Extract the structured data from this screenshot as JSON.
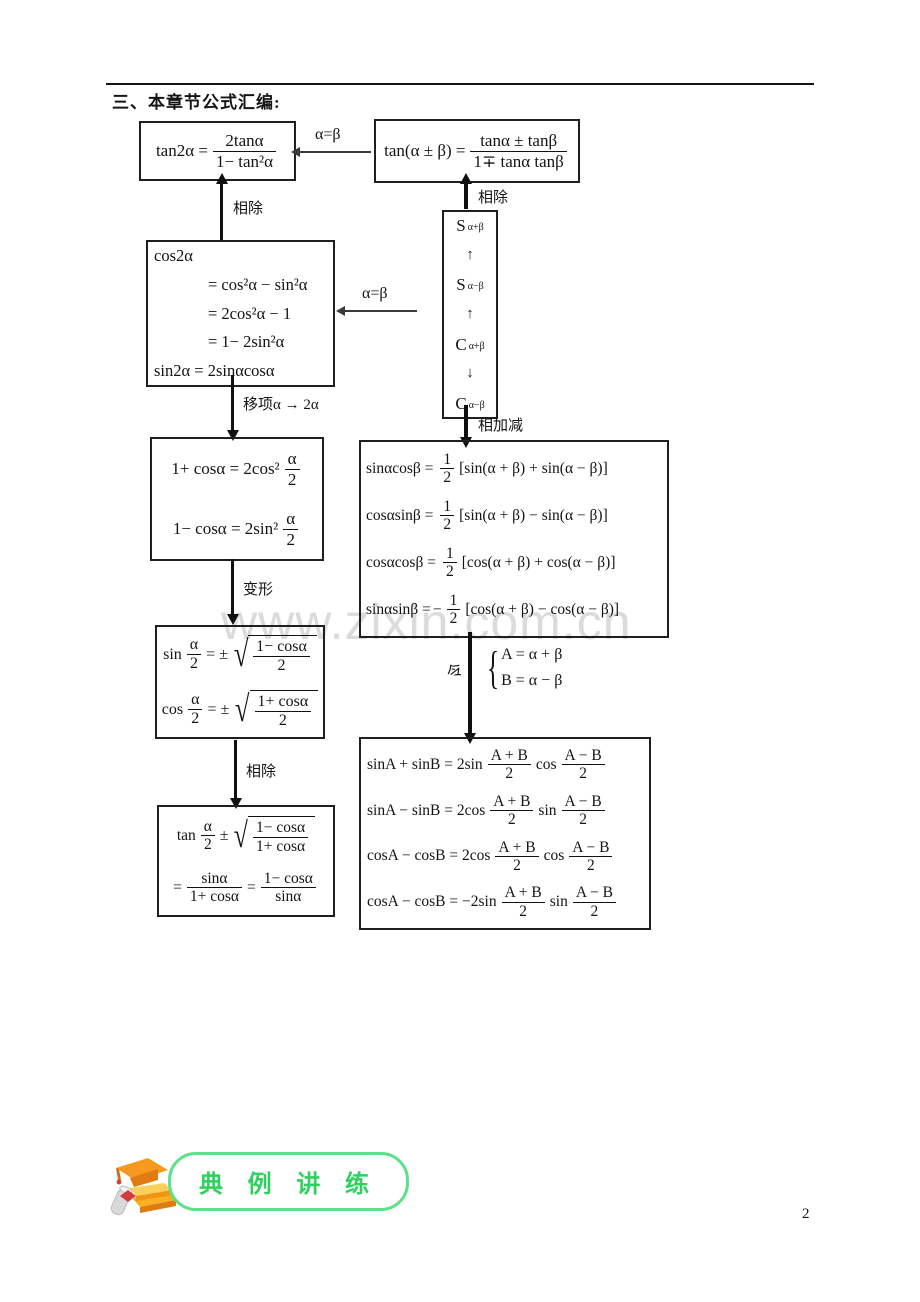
{
  "header": {
    "title": "三、本章节公式汇编:"
  },
  "watermark": "www.zixin.com.cn",
  "page_number": "2",
  "connectors": {
    "divide_left": "相除",
    "divide_right": "相除",
    "alpha_beta_top": "α=β",
    "alpha_beta_mid": "α=β",
    "shift": "移项α → 2α",
    "add_subtract": "相加减",
    "transform": "变形",
    "let": "令",
    "let_brace": "{",
    "let_line1": "A = α + β",
    "let_line2": "B = α − β",
    "divide_bottom": "相除"
  },
  "boxes": {
    "tan_double": {
      "lhs": "tan2α =",
      "num": "2tanα",
      "den": "1− tan²α"
    },
    "tan_sum": {
      "lhs": "tan(α ± β) =",
      "num": "tanα ± tanβ",
      "den": "1∓ tanα tanβ"
    },
    "cos_double": {
      "lines": [
        "cos2α",
        "= cos²α − sin²α",
        "= 2cos²α − 1",
        "= 1− 2sin²α",
        "sin2α = 2sinαcosα"
      ]
    },
    "sc_chain": {
      "items": [
        {
          "main": "S",
          "sub": "α+β"
        },
        {
          "arrow": "↑"
        },
        {
          "main": "S",
          "sub": "α−β"
        },
        {
          "arrow": "↑"
        },
        {
          "main": "C",
          "sub": "α+β"
        },
        {
          "arrow": "↓"
        },
        {
          "main": "C",
          "sub": "α−β"
        }
      ]
    },
    "power_reduce": {
      "rows": [
        {
          "pre": "1+ cosα = 2cos²",
          "num": "α",
          "den": "2"
        },
        {
          "pre": "1− cosα = 2sin²",
          "num": "α",
          "den": "2"
        }
      ]
    },
    "product_to_sum": {
      "rows": [
        {
          "lhs": "sinαcosβ =",
          "sign": "",
          "num": "1",
          "den": "2",
          "rhs": "[sin(α + β) + sin(α − β)]"
        },
        {
          "lhs": "cosαsinβ =",
          "sign": "",
          "num": "1",
          "den": "2",
          "rhs": "[sin(α + β) − sin(α − β)]"
        },
        {
          "lhs": "cosαcosβ =",
          "sign": "",
          "num": "1",
          "den": "2",
          "rhs": "[cos(α + β) + cos(α − β)]"
        },
        {
          "lhs": "sinαsinβ =",
          "sign": "−",
          "num": "1",
          "den": "2",
          "rhs": "[cos(α + β) − cos(α − β)]"
        }
      ]
    },
    "half_angle": {
      "rows": [
        {
          "fn": "sin",
          "anum": "α",
          "aden": "2",
          "mid": "= ±",
          "rnum": "1− cosα",
          "rden": "2"
        },
        {
          "fn": "cos",
          "anum": "α",
          "aden": "2",
          "mid": "= ±",
          "rnum": "1+ cosα",
          "rden": "2"
        }
      ]
    },
    "tan_half": {
      "line1": {
        "fn": "tan",
        "anum": "α",
        "aden": "2",
        "mid": "±",
        "rnum": "1− cosα",
        "rden": "1+ cosα"
      },
      "line2": {
        "eq1": "=",
        "n1": "sinα",
        "d1": "1+ cosα",
        "eq2": "=",
        "n2": "1− cosα",
        "d2": "sinα"
      }
    },
    "sum_to_product": {
      "rows": [
        {
          "lhs": "sinA + sinB = 2sin",
          "n1": "A + B",
          "d1": "2",
          "mid": "cos",
          "n2": "A − B",
          "d2": "2"
        },
        {
          "lhs": "sinA − sinB = 2cos",
          "n1": "A + B",
          "d1": "2",
          "mid": "sin",
          "n2": "A − B",
          "d2": "2"
        },
        {
          "lhs": "cosA − cosB = 2cos",
          "n1": "A + B",
          "d1": "2",
          "mid": "cos",
          "n2": "A − B",
          "d2": "2"
        },
        {
          "lhs": "cosA − cosB = −2sin",
          "n1": "A + B",
          "d1": "2",
          "mid": "sin",
          "n2": "A − B",
          "d2": "2"
        }
      ]
    }
  },
  "logo": {
    "text": "典 例 讲 练"
  },
  "colors": {
    "logo_green": "#2ed05f",
    "logo_orange": "#f59a1e",
    "watermark": "#dbdbdb"
  }
}
